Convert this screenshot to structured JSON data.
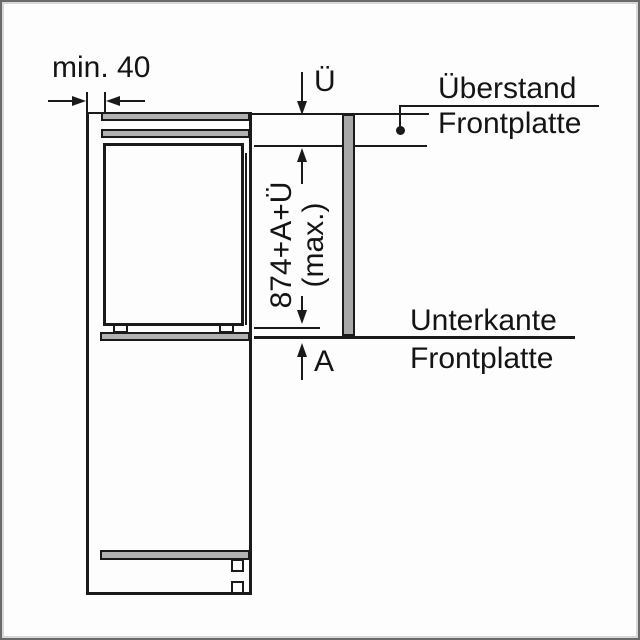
{
  "diagram_title": "built-in-appliance-front-panel-installation-diagram",
  "labels": {
    "min_gap": "min. 40",
    "overhang_symbol": "Ü",
    "overhang_name_line1": "Überstand",
    "overhang_name_line2": "Frontplatte",
    "panel_height_formula": "874+A+Ü",
    "panel_height_qualifier": "(max.)",
    "bottom_edge_name_line1": "Unterkante",
    "bottom_edge_name_line2": "Frontplatte",
    "gap_symbol": "A"
  },
  "colors": {
    "line": "#1a1a1a",
    "panel_fill": "#b2b2b2",
    "front_panel_fill": "#a8a8a8",
    "background": "#fdfdfd",
    "frame_border": "#6a6a6a"
  }
}
